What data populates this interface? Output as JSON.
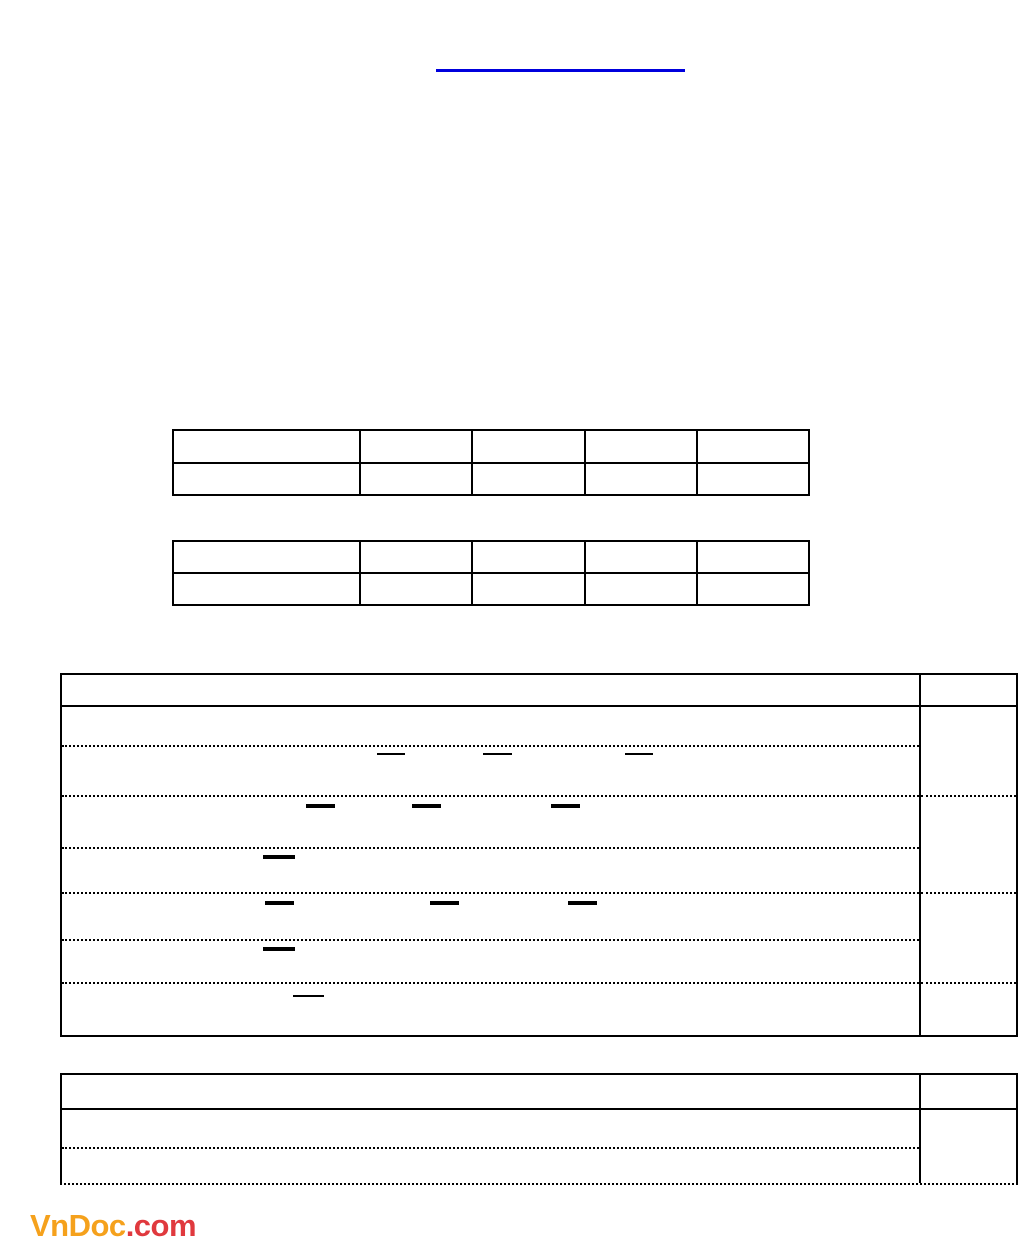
{
  "page": {
    "background": "#ffffff"
  },
  "top_link_rule": {
    "color": "#0000dd",
    "x": 436,
    "y": 69,
    "width": 249,
    "height": 3
  },
  "answer_tables": {
    "table_1": {
      "rows": 2,
      "columns": 5,
      "cell_values": [
        [
          "",
          "",
          "",
          "",
          ""
        ],
        [
          "",
          "",
          "",
          "",
          ""
        ]
      ]
    },
    "table_2": {
      "rows": 2,
      "columns": 5,
      "cell_values": [
        [
          "",
          "",
          "",
          "",
          ""
        ],
        [
          "",
          "",
          "",
          "",
          ""
        ]
      ]
    }
  },
  "exercise_table": {
    "header_cells": [
      "",
      ""
    ],
    "left_column_rows": [
      "",
      "",
      "",
      "",
      "",
      "",
      ""
    ],
    "right_column_cells": [
      "",
      "",
      "",
      ""
    ],
    "fraction_bars": [
      {
        "x": 377,
        "y": 753,
        "w": 28,
        "h": 2
      },
      {
        "x": 483,
        "y": 753,
        "w": 29,
        "h": 2
      },
      {
        "x": 625,
        "y": 753,
        "w": 28,
        "h": 2
      },
      {
        "x": 306,
        "y": 804,
        "w": 29,
        "h": 4
      },
      {
        "x": 412,
        "y": 804,
        "w": 29,
        "h": 4
      },
      {
        "x": 551,
        "y": 804,
        "w": 29,
        "h": 4
      },
      {
        "x": 263,
        "y": 855,
        "w": 32,
        "h": 4
      },
      {
        "x": 265,
        "y": 901,
        "w": 29,
        "h": 4
      },
      {
        "x": 430,
        "y": 901,
        "w": 29,
        "h": 4
      },
      {
        "x": 568,
        "y": 901,
        "w": 29,
        "h": 4
      },
      {
        "x": 263,
        "y": 947,
        "w": 32,
        "h": 4
      },
      {
        "x": 293,
        "y": 995,
        "w": 31,
        "h": 2
      }
    ]
  },
  "bottom_table": {
    "header_cells": [
      "",
      ""
    ],
    "left_column_rows": [
      "",
      ""
    ],
    "right_column_cells": [
      ""
    ]
  },
  "logo": {
    "brand": "VnDoc",
    "suffix": ".com",
    "brand_color": "#f5a11c",
    "suffix_color": "#e0393e"
  }
}
